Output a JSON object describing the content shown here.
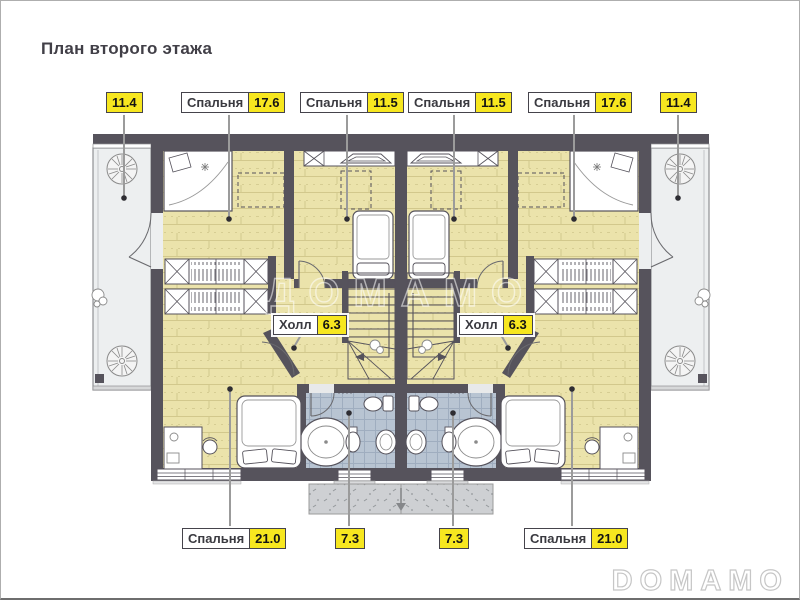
{
  "page": {
    "title": "План второго этажа",
    "watermark": "DOMAMO",
    "plan_watermark": "ДОМАМО"
  },
  "colors": {
    "wall": "#56535c",
    "wood_floor": "#ebe3ab",
    "tile_floor": "#b8c4d2",
    "balcony_floor": "#edeff0",
    "porch": "#ced0d3",
    "label_yellow": "#f7e71f",
    "label_border": "#45434b",
    "leader": "#9b9b9b",
    "title_color": "#413f47"
  },
  "labels": {
    "top": [
      {
        "area": "11.4"
      },
      {
        "room": "Спальня",
        "area": "17.6"
      },
      {
        "room": "Спальня",
        "area": "11.5"
      },
      {
        "room": "Спальня",
        "area": "11.5"
      },
      {
        "room": "Спальня",
        "area": "17.6"
      },
      {
        "area": "11.4"
      }
    ],
    "halls": [
      {
        "room": "Холл",
        "area": "6.3"
      },
      {
        "room": "Холл",
        "area": "6.3"
      }
    ],
    "bottom": [
      {
        "room": "Спальня",
        "area": "21.0"
      },
      {
        "area": "7.3"
      },
      {
        "area": "7.3"
      },
      {
        "room": "Спальня",
        "area": "21.0"
      }
    ]
  }
}
